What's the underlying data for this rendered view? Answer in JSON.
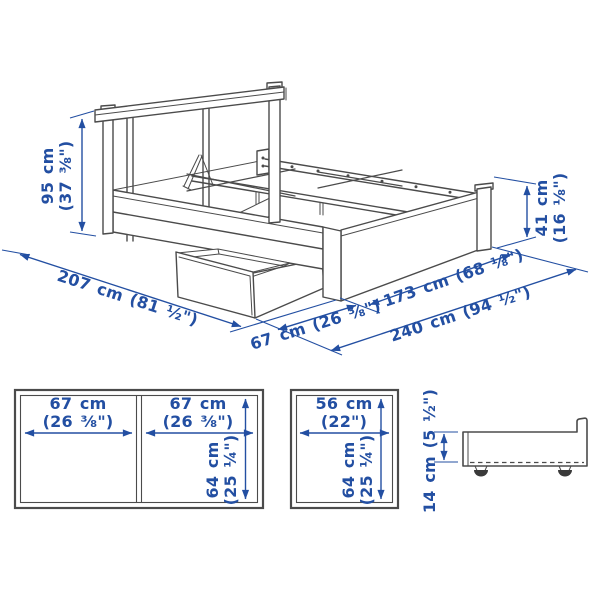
{
  "figure": {
    "type": "product-dimension-diagram",
    "product": "bed-frame-with-storage-boxes",
    "colors": {
      "line": "#4b4b4b",
      "dimension": "#234fa2",
      "background": "#ffffff"
    }
  },
  "main_view": {
    "headboard_height_value": "95 cm",
    "headboard_height_inches": "(37 ⅜\")",
    "footboard_height_value": "41 cm",
    "footboard_height_inches": "(16 ⅛\")",
    "bed_length_label": "207 cm (81 ½\")",
    "drawer_pullout_label": "67 cm (26 ⅜\")",
    "bed_width_label": "173 cm (68 ⅛\")",
    "clearance_width_label": "240 cm (94 ½\")"
  },
  "double_box_view": {
    "left_width_value": "67 cm",
    "left_width_inches": "(26 ⅜\")",
    "right_width_value": "67 cm",
    "right_width_inches": "(26 ⅜\")",
    "depth_value": "64 cm",
    "depth_inches": "(25 ¼\")"
  },
  "single_box_view": {
    "width_value": "56 cm",
    "width_inches": "(22\")",
    "depth_value": "64 cm",
    "depth_inches": "(25 ¼\")"
  },
  "side_box_view": {
    "height_label": "14 cm (5 ½\")"
  }
}
